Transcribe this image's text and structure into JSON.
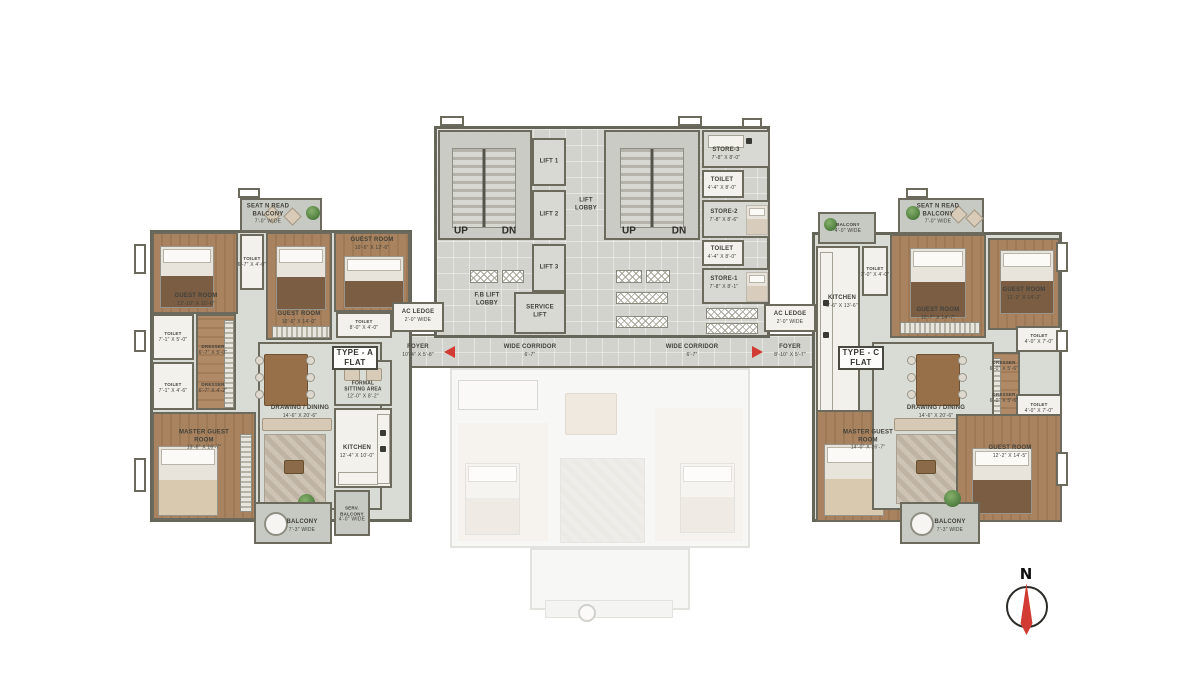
{
  "colors": {
    "accent_red": "#d23b33",
    "wall": "#6b6a5d",
    "wood_floor": "#a8825f",
    "light_floor": "#d9dbd5"
  },
  "compass": {
    "north": "N"
  },
  "corridor": {
    "label": "WIDE CORRIDOR",
    "dim": "6'-7\""
  },
  "core": {
    "up": "UP",
    "dn": "DN",
    "lift1": "LIFT 1",
    "lift2": "LIFT 2",
    "lift3": "LIFT 3",
    "lift_lobby": "LIFT LOBBY",
    "fb_lift_lobby": "F.B LIFT LOBBY",
    "service_lift": "SERVICE LIFT",
    "store3": {
      "name": "STORE-3",
      "dim": "7'-8\" X 8'-0\""
    },
    "toilet_a": {
      "name": "TOILET",
      "dim": "4'-4\" X 8'-0\""
    },
    "store2": {
      "name": "STORE-2",
      "dim": "7'-8\" X 8'-6\""
    },
    "toilet_b": {
      "name": "TOILET",
      "dim": "4'-4\" X 8'-0\""
    },
    "store1": {
      "name": "STORE-1",
      "dim": "7'-8\" X 8'-1\""
    }
  },
  "flat_a": {
    "tag_line1": "TYPE - A",
    "tag_line2": "FLAT",
    "seat_balcony": {
      "name": "SEAT N READ BALCONY",
      "dim": "7'-0\" WIDE"
    },
    "guest_room_1": {
      "name": "GUEST ROOM",
      "dim": "12'-10\" X 10'-6\""
    },
    "toilet_top": {
      "name": "TOILET",
      "dim": "6'-7\" X 4'-0\""
    },
    "guest_room_2": {
      "name": "GUEST ROOM",
      "dim": "10'-6\" X 14'-0\""
    },
    "guest_room_3": {
      "name": "GUEST ROOM",
      "dim": "10'-6\" X 12'-6\""
    },
    "toilet_right": {
      "name": "TOILET",
      "dim": "8'-0\" X 4'-0\""
    },
    "toilet_left_1": {
      "name": "TOILET",
      "dim": "7'-1\" X 5'-0\""
    },
    "dresser_1": {
      "name": "DRESSER",
      "dim": "6'-7\" X 5'-0\""
    },
    "toilet_left_2": {
      "name": "TOILET",
      "dim": "7'-1\" X 4'-6\""
    },
    "dresser_2": {
      "name": "DRESSER",
      "dim": "6'-7\" X 4'-2\""
    },
    "master_guest_room": {
      "name": "MASTER GUEST ROOM",
      "dim": "13'-6\" X 16'-7\""
    },
    "drawing_dining": {
      "name": "DRAWING / DINING",
      "dim": "14'-6\" X 20'-6\""
    },
    "formal_sitting": {
      "name": "FORMAL SITTING AREA",
      "dim": "12'-0\" X 8'-2\""
    },
    "kitchen": {
      "name": "KITCHEN",
      "dim": "12'-4\" X 10'-0\""
    },
    "serv_balcony": {
      "name": "SERV. BALCONY",
      "dim": "4'-0\" WIDE"
    },
    "balcony": {
      "name": "BALCONY",
      "dim": "7'-3\" WIDE"
    },
    "foyer": {
      "name": "FOYER",
      "dim": "10'-4\" X 5'-8\""
    },
    "ac_ledge": {
      "name": "AC LEDGE",
      "dim": "2'-0\" WIDE"
    }
  },
  "flat_c": {
    "tag_line1": "TYPE - C",
    "tag_line2": "FLAT",
    "balcony_top": {
      "name": "BALCONY",
      "dim": "4'-0\" WIDE"
    },
    "seat_balcony": {
      "name": "SEAT N READ BALCONY",
      "dim": "7'-0\" WIDE"
    },
    "kitchen": {
      "name": "KITCHEN",
      "dim": "8'-6\" X 13'-6\""
    },
    "toilet_top": {
      "name": "TOILET",
      "dim": "7'-0\" X 4'-0\""
    },
    "guest_room_1": {
      "name": "GUEST ROOM",
      "dim": "10'-7\" X 14'-7\""
    },
    "guest_room_2": {
      "name": "GUEST ROOM",
      "dim": "12'-2\" X 14'-2\""
    },
    "toilet_right_1": {
      "name": "TOILET",
      "dim": "4'-0\" X 7'-0\""
    },
    "dresser_1": {
      "name": "DRESSER",
      "dim": "6'-0\" X 5'-6\""
    },
    "dresser_2": {
      "name": "DRESSER",
      "dim": "6'-0\" X 5'-6\""
    },
    "toilet_right_2": {
      "name": "TOILET",
      "dim": "4'-0\" X 7'-0\""
    },
    "master_guest_room": {
      "name": "MASTER GUEST ROOM",
      "dim": "14'-0\" X 16'-7\""
    },
    "drawing_dining": {
      "name": "DRAWING / DINING",
      "dim": "14'-6\" X 20'-6\""
    },
    "guest_room_3": {
      "name": "GUEST ROOM",
      "dim": "12'-2\" X 14'-5\""
    },
    "balcony": {
      "name": "BALCONY",
      "dim": "7'-3\" WIDE"
    },
    "foyer": {
      "name": "FOYER",
      "dim": "8'-10\" X 5'-7\""
    },
    "ac_ledge": {
      "name": "AC LEDGE",
      "dim": "2'-0\" WIDE"
    }
  }
}
